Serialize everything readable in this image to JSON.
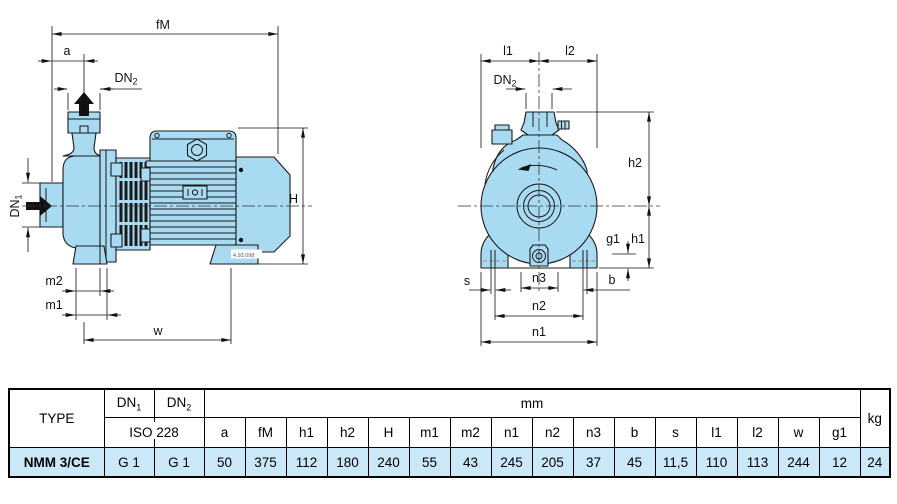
{
  "colors": {
    "pump_fill": "#a8daf2",
    "outline": "#1a1a1a",
    "table_row_bg": "#cbe8f8"
  },
  "left_view": {
    "dims": {
      "fM": "fM",
      "a": "a",
      "H": "H",
      "m2": "m2",
      "m1": "m1",
      "w": "w"
    },
    "dn1": {
      "text": "DN",
      "sub": "1"
    },
    "dn2": {
      "text": "DN",
      "sub": "2"
    },
    "drawing_number": "4.93.098"
  },
  "right_view": {
    "dims": {
      "l1": "l1",
      "l2": "l2",
      "h2": "h2",
      "h1": "h1",
      "g1": "g1",
      "s": "s",
      "n3": "n3",
      "b": "b",
      "n2": "n2",
      "n1": "n1"
    },
    "dn2": {
      "text": "DN",
      "sub": "2"
    }
  },
  "table": {
    "type_header": "TYPE",
    "dn1": {
      "text": "DN",
      "sub": "1"
    },
    "dn2": {
      "text": "DN",
      "sub": "2"
    },
    "iso_header": "ISO 228",
    "mm_header": "mm",
    "kg_header": "kg",
    "dim_headers": [
      "a",
      "fM",
      "h1",
      "h2",
      "H",
      "m1",
      "m2",
      "n1",
      "n2",
      "n3",
      "b",
      "s",
      "l1",
      "l2",
      "w",
      "g1"
    ],
    "row": {
      "type": "NMM 3/CE",
      "dn1": "G 1",
      "dn2": "G 1",
      "values": [
        "50",
        "375",
        "112",
        "180",
        "240",
        "55",
        "43",
        "245",
        "205",
        "37",
        "45",
        "11,5",
        "110",
        "113",
        "244",
        "12"
      ],
      "kg": "24"
    }
  }
}
